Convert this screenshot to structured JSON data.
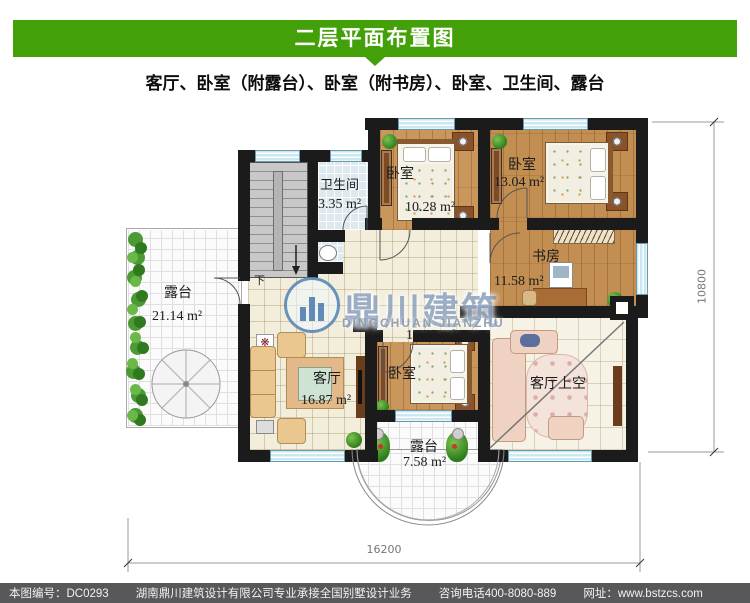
{
  "header": {
    "title": "二层平面布置图",
    "subtitle": "客厅、卧室（附露台）、卧室（附书房）、卧室、卫生间、露台"
  },
  "watermark": {
    "brand_cn": "鼎川建筑",
    "brand_en": "DINGCHUAN JIANZHU"
  },
  "plan": {
    "rooms": [
      {
        "id": "bathroom",
        "name": "卫生间",
        "area": "3.35 m²"
      },
      {
        "id": "bedroom-top-center",
        "name": "卧室",
        "area": "10.28 m²"
      },
      {
        "id": "bedroom-top-right",
        "name": "卧室",
        "area": "13.04 m²"
      },
      {
        "id": "study",
        "name": "书房",
        "area": "11.58 m²"
      },
      {
        "id": "terrace-left",
        "name": "露台",
        "area": "21.14 m²"
      },
      {
        "id": "living-room",
        "name": "客厅",
        "area": "16.87 m²"
      },
      {
        "id": "bedroom-bottom",
        "name": "卧室",
        "area": "10.28 m²"
      },
      {
        "id": "living-void",
        "name": "客厅上空",
        "area": ""
      },
      {
        "id": "terrace-bottom",
        "name": "露台",
        "area": "7.58 m²"
      }
    ],
    "stair_label": "下",
    "dimensions": {
      "width_mm": "16200",
      "height_mm": "10800"
    }
  },
  "footer": {
    "sheet_no": "本图编号：DC0293",
    "company": "湖南鼎川建筑设计有限公司专业承接全国别墅设计业务",
    "phone": "咨询电话400-8080-889",
    "website": "网址：www.bstzcs.com"
  },
  "palette": {
    "green": "#44A008",
    "footer_bg": "#58585B",
    "wall": "#1b1b1b",
    "window_blue": "#c9e8f2",
    "wood": "#c9965b",
    "tile_cream": "#f3eedc",
    "bath_blue": "#dde9ee",
    "watermark_blue": "#5878a8"
  }
}
